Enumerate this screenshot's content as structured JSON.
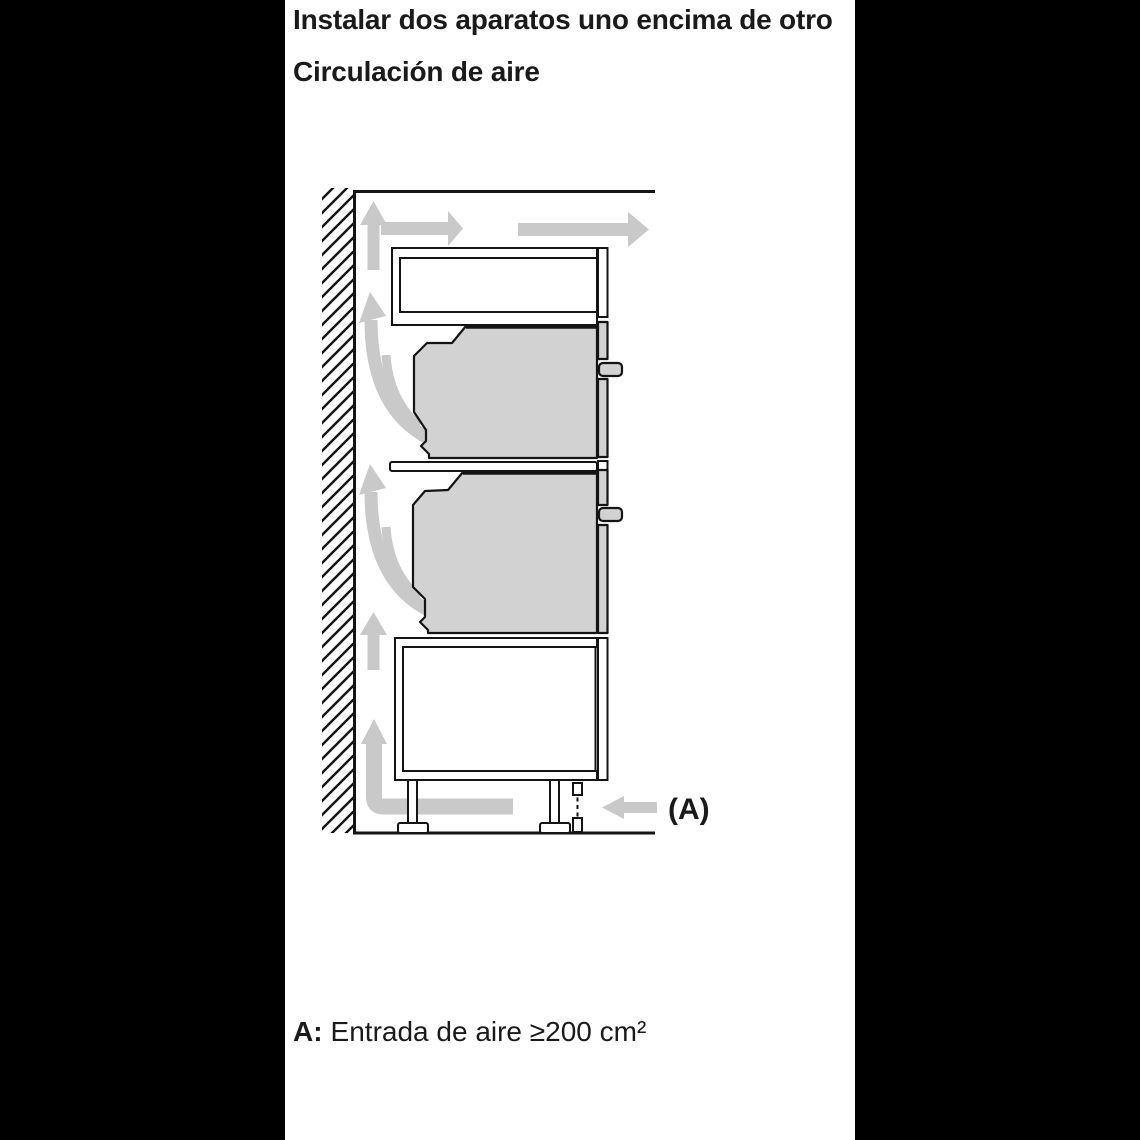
{
  "page": {
    "title": "Instalar dos aparatos uno encima de otro",
    "subtitle": "Circulación de aire",
    "caption_prefix": "A:",
    "caption_body": "Entrada de aire ≥200 cm²"
  },
  "diagram": {
    "inlet_label": "(A)"
  },
  "colors": {
    "paper": "#ffffff",
    "frame": "#000000",
    "arrow": "#c9c9c9",
    "appliance": "#d2d2d2",
    "outline": "#141414",
    "text": "#1a1a1a"
  }
}
